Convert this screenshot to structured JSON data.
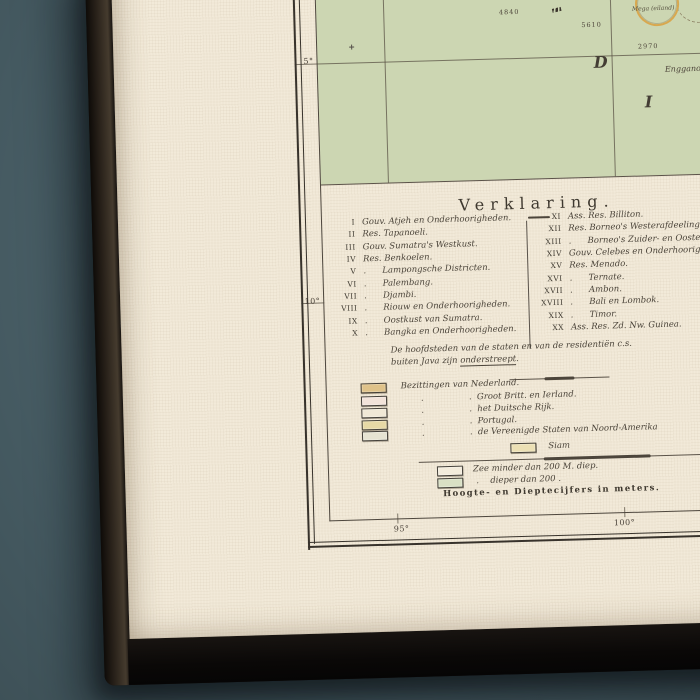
{
  "scene": {
    "wall_color": "#4c636b",
    "canvas_color": "#f2ead9"
  },
  "map": {
    "colors": {
      "sea": "#ccd6b2",
      "island_outline": "#d8a84f"
    },
    "graticule": {
      "lat_labels": [
        "5°",
        "10°"
      ],
      "lon_labels": [
        "95°",
        "100°"
      ]
    },
    "depth_soundings": [
      "4840",
      "5610",
      "2970"
    ],
    "ocean_letters": [
      "D",
      "I"
    ],
    "island_labels": [
      "Mega (eiland)",
      "Enggano"
    ]
  },
  "legend": {
    "title": "Verklaring.",
    "entries_left": [
      {
        "num": "I",
        "label": "Gouv. Atjeh en Onderhoorigheden."
      },
      {
        "num": "II",
        "label": "Res. Tapanoeli."
      },
      {
        "num": "III",
        "label": "Gouv. Sumatra's Westkust."
      },
      {
        "num": "IV",
        "label": "Res. Benkoelen."
      },
      {
        "num": "V",
        "label": ".      Lampongsche Districten."
      },
      {
        "num": "VI",
        "label": ".      Palembang."
      },
      {
        "num": "VII",
        "label": ".      Djambi."
      },
      {
        "num": "VIII",
        "label": ".      Riouw en Onderhoorigheden."
      },
      {
        "num": "IX",
        "label": ".      Oostkust van Sumatra."
      },
      {
        "num": "X",
        "label": ".      Bangka en Onderhoorigheden."
      }
    ],
    "entries_right": [
      {
        "num": "XI",
        "label": "Ass. Res. Billiton."
      },
      {
        "num": "XII",
        "label": "Res. Borneo's Westerafdeeling."
      },
      {
        "num": "XIII",
        "label": ".      Borneo's Zuider- en Oosterafdeeling."
      },
      {
        "num": "XIV",
        "label": "Gouv. Celebes en Onderhoorigheden."
      },
      {
        "num": "XV",
        "label": "Res. Menado."
      },
      {
        "num": "XVI",
        "label": ".      Ternate."
      },
      {
        "num": "XVII",
        "label": ".      Ambon."
      },
      {
        "num": "XVIII",
        "label": ".      Bali en Lombok."
      },
      {
        "num": "XIX",
        "label": ".      Timor."
      },
      {
        "num": "XX",
        "label": "Ass. Res. Zd. Nw. Guinea."
      }
    ],
    "note_line1": "De hoofdsteden van de staten en van de residentiën c.s.",
    "note_line2_plain": "buiten Java zijn ",
    "note_line2_underlined": "onderstreept",
    "note_line2_period": ".",
    "ditto_mark": ".",
    "possessions": [
      {
        "color": "#dfc289",
        "label": "Bezittingen van Nederland."
      },
      {
        "color": "#f2e3da",
        "label": "Groot Britt. en Ierland."
      },
      {
        "color": "#f0e8d6",
        "label": "het Duitsche Rijk."
      },
      {
        "color": "#e7d9a5",
        "label": "Portugal."
      },
      {
        "color": "#e6e3d2",
        "label": "de Vereenigde Staten van Noord-Amerika"
      }
    ],
    "siam": {
      "color": "#ece0b4",
      "label": "Siam"
    },
    "depth_rows": [
      {
        "color": "#f3ecdc",
        "prefix": "",
        "label": "Zee minder dan 200 M. diep."
      },
      {
        "color": "#d9e0c4",
        "prefix": ".",
        "label": "dieper dan 200 ."
      }
    ],
    "footer": "Hoogte- en Dieptecijfers in meters."
  }
}
